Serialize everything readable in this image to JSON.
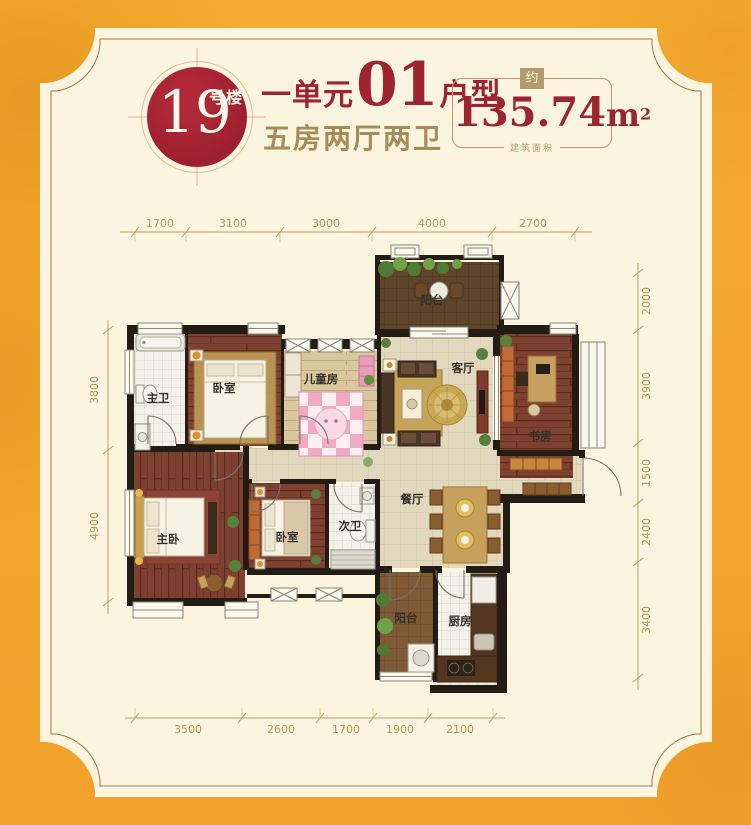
{
  "header": {
    "badge": {
      "number": "19",
      "suffix": "号楼"
    },
    "title": {
      "part1": "一单元",
      "big": "01",
      "part2": "户型"
    },
    "subtitle": "五房两厅两卫",
    "area": {
      "tag": "约",
      "value": "135.74",
      "unit": "m",
      "power": "2",
      "caption": "建筑面积"
    }
  },
  "plan": {
    "rooms": {
      "master_bath": "主卫",
      "bedroom_a": "卧室",
      "kids_room": "儿童房",
      "living_room": "客厅",
      "balcony_north": "阳台",
      "study": "书房",
      "master_bedroom": "主卧",
      "bedroom_b": "卧室",
      "second_bath": "次卫",
      "dining_room": "餐厅",
      "balcony_south": "阳台",
      "kitchen": "厨房"
    },
    "dims": {
      "top": [
        "1700",
        "3100",
        "3000",
        "4000",
        "2700"
      ],
      "bottom": [
        "3500",
        "2600",
        "1700",
        "1900",
        "2100"
      ],
      "left": [
        "3800",
        "4900"
      ],
      "right": [
        "2000",
        "3900",
        "1500",
        "2400",
        "3400"
      ]
    }
  },
  "colors": {
    "accent_red": "#9E2431",
    "badge_red": "#A02330",
    "gold_text": "#A68D58",
    "dim_text": "#AD9A5F",
    "panel_cream": "#FBF4DF",
    "background_orange": "#F3A42C",
    "wall_black": "#221C15"
  }
}
